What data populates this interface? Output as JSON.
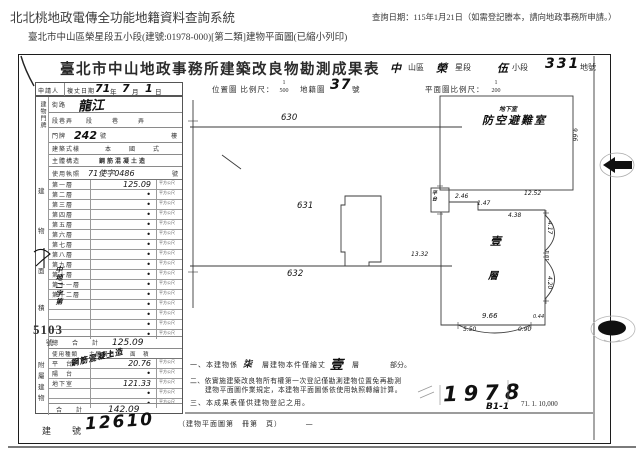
{
  "header": {
    "system_title": "北北桃地政電傳全功能地籍資料查詢系統",
    "query_date": "查詢日期：115年1月21日（如需登記謄本，請向地政事務所申請。）",
    "doc_line": "臺北市中山區榮星段五小段(建號:01978-000)[第二類]建物平面圖(已縮小列印)"
  },
  "title": {
    "main": "臺北市中山地政事務所建築改良物勘測成果表",
    "district_hand": "中",
    "district_label": "山區",
    "section_hand": "榮",
    "section_label": "星段",
    "subsection_hand": "伍",
    "subsection_label": "小段",
    "parcel_hand": "331",
    "parcel_label": "地號"
  },
  "survey": {
    "applicant_label": "申請人",
    "date_label": "複丈日期",
    "date_year": "71",
    "year_label": "年",
    "date_month": "7",
    "month_label": "月",
    "date_day": "1",
    "day_label": "日",
    "location_map_label": "位置圖 比例尺：",
    "location_scale_num": "1",
    "location_scale_den": "500",
    "cadastral_label": "地籍圖",
    "cadastral_number": "37",
    "cadastral_unit": "號",
    "plan_scale_label": "平面圖比例尺：",
    "plan_scale_num": "1",
    "plan_scale_den": "200"
  },
  "address": {
    "group_label": "建物門牌",
    "street_label": "街路",
    "street_value": "龍江",
    "lane_label": "段巷弄",
    "lane_seg": "段",
    "lane_lane": "巷",
    "lane_alley": "弄",
    "door_label": "門牌",
    "door_value": "242",
    "door_unit": "號",
    "floor_label": "樓"
  },
  "building": {
    "style_label": "建築式樣",
    "style_value": "本　國　式",
    "structure_label": "主體構造",
    "structure_value": "鋼筋混凝土造",
    "license_label": "使用執照",
    "license_value": "71使字0486",
    "license_unit": "號"
  },
  "floor_area": {
    "side_label": "建物面積",
    "unit": "平方公尺",
    "rows": [
      {
        "label": "第一層",
        "value": "125.09"
      },
      {
        "label": "第二層",
        "value": "•"
      },
      {
        "label": "第三層",
        "value": "•"
      },
      {
        "label": "第四層",
        "value": "•"
      },
      {
        "label": "第五層",
        "value": "•"
      },
      {
        "label": "第六層",
        "value": "•"
      },
      {
        "label": "第七層",
        "value": "•"
      },
      {
        "label": "第八層",
        "value": "•"
      },
      {
        "label": "第九層",
        "value": "•"
      },
      {
        "label": "第十層",
        "value": "•"
      },
      {
        "label": "第十一層",
        "value": "•"
      },
      {
        "label": "第十二層",
        "value": "•"
      },
      {
        "label": "",
        "value": "•"
      },
      {
        "label": "",
        "value": "•"
      },
      {
        "label": "",
        "value": "•"
      },
      {
        "label": "",
        "value": "•"
      }
    ],
    "total_label": "總　合　計",
    "total_value": "125.09"
  },
  "attached": {
    "side_label": "附屬建物",
    "col_use": "使用種類",
    "col_structure": "主體構造",
    "col_area": "面　積",
    "structure_hand": "鋼筋混凝土造",
    "rows": [
      {
        "label": "平　台",
        "value": "20.76"
      },
      {
        "label": "陽　台",
        "value": "•"
      },
      {
        "label": "地下室",
        "value": "121.33"
      },
      {
        "label": "",
        "value": "•"
      },
      {
        "label": "",
        "value": "•"
      }
    ],
    "total_label": "合　計",
    "total_value": "142.09"
  },
  "stamp": {
    "prefix": "中地二字第",
    "number": "5103",
    "suffix": "號"
  },
  "notes": {
    "n1_prefix": "一、本建物係",
    "n1_hand1": "柒",
    "n1_mid": "層建物本件僅繪丈",
    "n1_hand2": "壹",
    "n1_mid2": "層",
    "n1_suffix": "部分。",
    "n2_line1": "二、依實施建築改良物所有權第一次登記僅勘測建物位置免再勘測",
    "n2_line2": "建物平面圖作業規定，本建物平面圖係依使用執照轉繪計算。",
    "n3": "三、本成果表僅供建物登記之用。"
  },
  "footer": {
    "building_no_label": "建　號",
    "building_no_value": "12610",
    "plan_book": "（建物平面圖第　冊第　頁）",
    "plan_book_hand": "一",
    "hand_number": "1978",
    "hand_code": "B1-1",
    "print_code": "71. 1. 10,000"
  },
  "location_map": {
    "parcel_top": "630",
    "parcel_mid": "631",
    "parcel_bottom": "632"
  },
  "basement_plan": {
    "label_small": "地下室",
    "label_large": "防空避難室",
    "dim_right": "9.66",
    "dim_bottom": "12.52"
  },
  "floor_plan": {
    "room_label_1": "壹",
    "room_label_2": "層",
    "platform_label": "平台",
    "dim_left": "13.32",
    "dim_top1": "2.46",
    "dim_top2": "1.47",
    "dim_top3": "4.38",
    "dim_bottom": "9.66",
    "dim_bottom2": "5.50",
    "dim_bottom3": "0.90",
    "dim_right1": "4.17",
    "dim_right2": "1.01",
    "dim_right3": "4.20",
    "dim_right4": "0.44"
  }
}
